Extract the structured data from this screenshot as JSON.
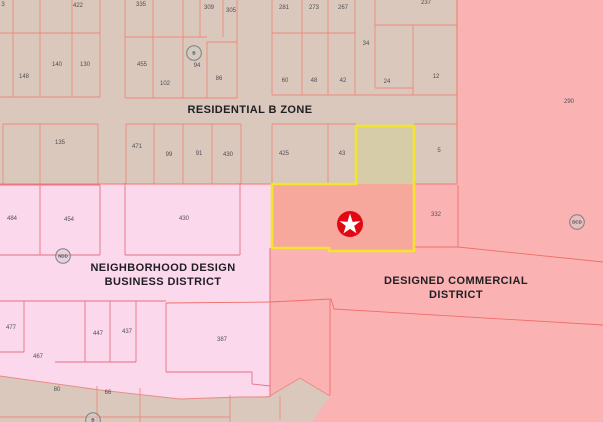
{
  "map": {
    "title": "zoning district map",
    "zones": {
      "residential": {
        "label": "RESIDENTIAL B ZONE"
      },
      "ndd": {
        "line1": "NEIGHBORHOOD DESIGN",
        "line2": "BUSINESS DISTRICT"
      },
      "dcd": {
        "line1": "DESIGNED COMMERCIAL",
        "line2": "DISTRICT"
      }
    },
    "colors": {
      "residential_tan": "#d9c8bb",
      "ndd_pink": "#fcd8ec",
      "dcd_salmon": "#fbb2b3",
      "highlight_yellow": "#f2e42f",
      "highlight_parcel_salmon": "#f7a89d",
      "highlight_parcel_tan": "#d6cca7",
      "star_red": "#e30613",
      "parcel_line_red": "#ee8a7c"
    },
    "markers": [
      {
        "label": "B",
        "x": 194,
        "y": 53
      },
      {
        "label": "NDD",
        "x": 63,
        "y": 256
      },
      {
        "label": "DCD",
        "x": 577,
        "y": 222
      },
      {
        "label": "B",
        "x": 93,
        "y": 420
      }
    ],
    "parcels": [
      {
        "label": "3",
        "x": 3,
        "y": 4
      },
      {
        "label": "422",
        "x": 78,
        "y": 5
      },
      {
        "label": "148",
        "x": 24,
        "y": 76
      },
      {
        "label": "140",
        "x": 57,
        "y": 64
      },
      {
        "label": "130",
        "x": 85,
        "y": 64
      },
      {
        "label": "335",
        "x": 141,
        "y": 4
      },
      {
        "label": "309",
        "x": 209,
        "y": 7
      },
      {
        "label": "305",
        "x": 231,
        "y": 10
      },
      {
        "label": "455",
        "x": 142,
        "y": 64
      },
      {
        "label": "102",
        "x": 165,
        "y": 83
      },
      {
        "label": "94",
        "x": 197,
        "y": 65
      },
      {
        "label": "86",
        "x": 219,
        "y": 78
      },
      {
        "label": "281",
        "x": 284,
        "y": 7
      },
      {
        "label": "273",
        "x": 314,
        "y": 7
      },
      {
        "label": "267",
        "x": 343,
        "y": 7
      },
      {
        "label": "237",
        "x": 426,
        "y": 2
      },
      {
        "label": "34",
        "x": 366,
        "y": 43
      },
      {
        "label": "60",
        "x": 285,
        "y": 80
      },
      {
        "label": "48",
        "x": 314,
        "y": 80
      },
      {
        "label": "42",
        "x": 343,
        "y": 80
      },
      {
        "label": "24",
        "x": 387,
        "y": 81
      },
      {
        "label": "12",
        "x": 436,
        "y": 76
      },
      {
        "label": "290",
        "x": 569,
        "y": 101
      },
      {
        "label": "135",
        "x": 60,
        "y": 142
      },
      {
        "label": "471",
        "x": 137,
        "y": 146
      },
      {
        "label": "99",
        "x": 169,
        "y": 154
      },
      {
        "label": "91",
        "x": 199,
        "y": 153
      },
      {
        "label": "430",
        "x": 228,
        "y": 154
      },
      {
        "label": "425",
        "x": 284,
        "y": 153
      },
      {
        "label": "43",
        "x": 342,
        "y": 153
      },
      {
        "label": "5",
        "x": 439,
        "y": 150
      },
      {
        "label": "484",
        "x": 12,
        "y": 218
      },
      {
        "label": "454",
        "x": 69,
        "y": 219
      },
      {
        "label": "430",
        "x": 184,
        "y": 218
      },
      {
        "label": "332",
        "x": 436,
        "y": 214
      },
      {
        "label": "477",
        "x": 11,
        "y": 327
      },
      {
        "label": "447",
        "x": 98,
        "y": 333
      },
      {
        "label": "437",
        "x": 127,
        "y": 331
      },
      {
        "label": "387",
        "x": 222,
        "y": 339
      },
      {
        "label": "467",
        "x": 38,
        "y": 356
      },
      {
        "label": "80",
        "x": 57,
        "y": 389
      },
      {
        "label": "66",
        "x": 108,
        "y": 392
      }
    ]
  }
}
